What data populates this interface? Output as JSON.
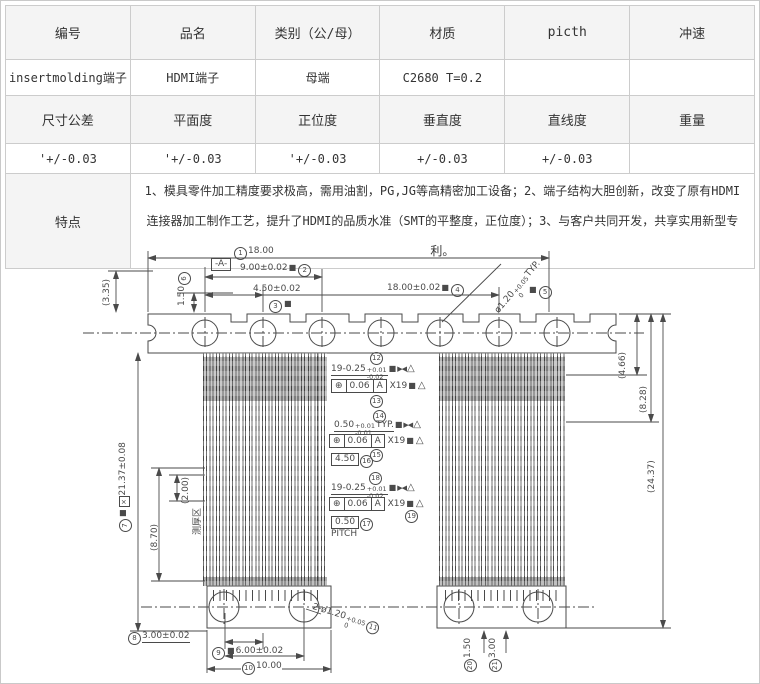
{
  "colors": {
    "line": "#4a4a4a",
    "table_header_bg": "#f4f4f4",
    "table_border": "#cccccc"
  },
  "table": {
    "columns": [
      "编号",
      "品名",
      "类别（公/母）",
      "材质",
      "picth",
      "冲速"
    ],
    "values": [
      "insertmolding端子",
      "HDMI端子",
      "母端",
      "C2680 T=0.2",
      "",
      ""
    ],
    "columns2": [
      "尺寸公差",
      "平面度",
      "正位度",
      "垂直度",
      "直线度",
      "重量"
    ],
    "values2": [
      "'+/-0.03",
      "'+/-0.03",
      "'+/-0.03",
      "+/-0.03",
      "+/-0.03",
      ""
    ],
    "feature_label": "特点",
    "feature_text": "1、模具零件加工精度要求极高，需用油割，PG,JG等高精密加工设备；2、端子结构大胆创新，改变了原有HDMI连接器加工制作工艺，提升了HDMI的品质水准（SMT的平整度，正位度）；3、与客户共同开发，共享实用新型专利。"
  },
  "drawing": {
    "balloons": [
      "1",
      "2",
      "3",
      "4",
      "5",
      "6",
      "7",
      "8",
      "9",
      "10",
      "11",
      "12",
      "13",
      "14",
      "15",
      "16",
      "17",
      "18",
      "19",
      "20",
      "21"
    ],
    "ann": {
      "top18": "18.00",
      "datum": "-A-",
      "d9": "9.00±0.02",
      "d45": "4.50±0.02",
      "d18": "18.00±0.02",
      "hole_typ_pre": "ø1.20",
      "hole_typ_up": "+0.05",
      "hole_typ_dn": "0",
      "hole_typ_suf": "TYP.",
      "c335": "(3.35)",
      "tl150": "1.50",
      "left_main": "21.37±0.08",
      "c870": "(8.70)",
      "c200": "(2.00)",
      "zone": "测厚区",
      "r466": "(4.66)",
      "r828": "(8.28)",
      "r2437": "(24.37)",
      "teeth_pre": "19-0.25",
      "teeth_up": "+0.01",
      "teeth_dn": "-0.02",
      "pitch_pre": "0.50",
      "pitch_up": "+0.01",
      "pitch_dn": "-0.01",
      "pitch_suf": "TYP.",
      "fcf_sym": "⊕",
      "fcf_val": "0.06",
      "fcf_datum": "A",
      "fcf_count": "X19",
      "basic450": "4.50",
      "basic050": "0.50",
      "pitch_label": "PITCH",
      "b300": "3.00±0.02",
      "b600": "6.00±0.02",
      "b1000": "10.00",
      "holes2_pre": "2-ø1.20",
      "holes2_up": "+0.05",
      "holes2_dn": "0",
      "br150": "1.50",
      "br300": "3.00",
      "sym_sq": "■",
      "sym_bowtie": "▶◀",
      "sym_flag": "△",
      "sym_x": "×"
    }
  }
}
